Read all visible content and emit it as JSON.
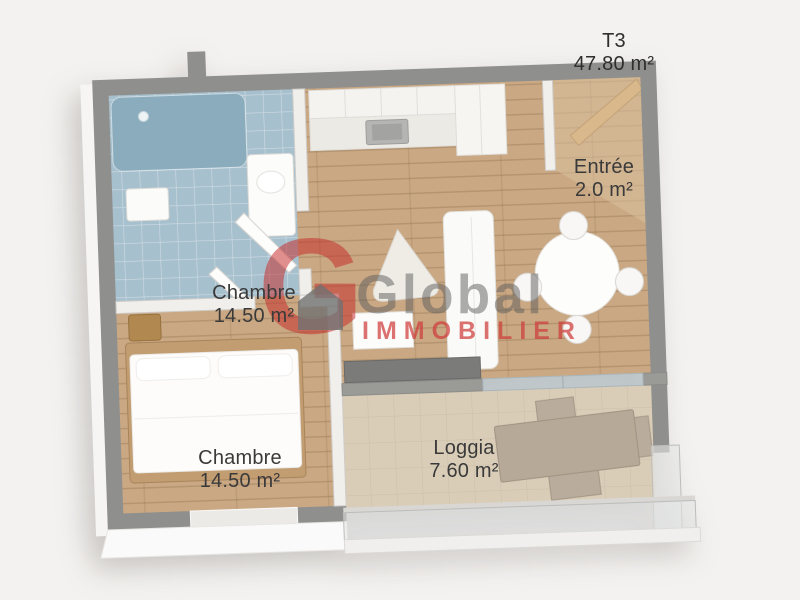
{
  "header": {
    "type_label": "T3",
    "total_area": "47.80 m²"
  },
  "rooms": {
    "entree": {
      "name": "Entrée",
      "area": "2.0 m²"
    },
    "chambre_main": {
      "name": "Chambre",
      "area": "14.50 m²"
    },
    "chambre_bottom": {
      "name": "Chambre",
      "area": "14.50 m²"
    },
    "loggia": {
      "name": "Loggia",
      "area": "7.60 m²"
    }
  },
  "watermark": {
    "monogram": "G",
    "brand": "Global",
    "tagline": "IMMOBILIER"
  },
  "colors": {
    "background": "#f4f2f0",
    "wall_top": "#8f8f8d",
    "wall_face": "#fbfafa",
    "wood_floor": "#c9a883",
    "entry_wood": "#d8c09c",
    "loggia_floor": "#dacdb8",
    "bathroom_tile": "#a7c0cd",
    "shower_tile": "#8aacbd",
    "brand_red": "#c62a28",
    "brand_gray": "#5c5c5c",
    "label_text": "#3a3a3a"
  }
}
